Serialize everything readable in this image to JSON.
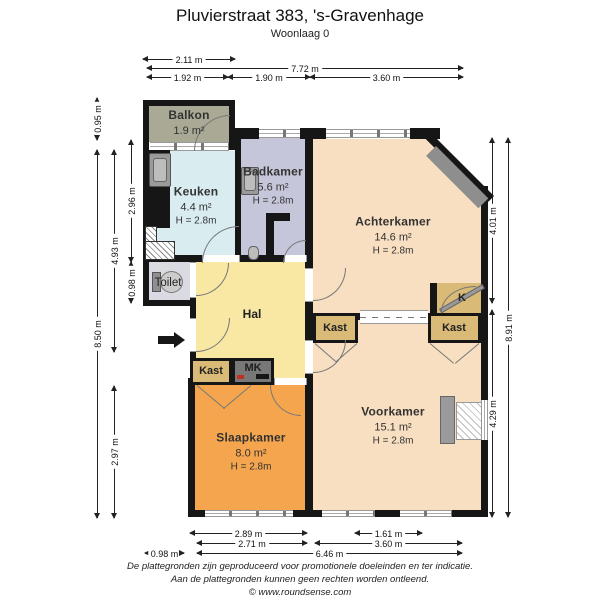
{
  "page": {
    "title": "Pluvierstraat 383, 's-Gravenhage",
    "subtitle": "Woonlaag 0"
  },
  "rooms": {
    "balkon": {
      "name": "Balkon",
      "area": "1.9 m²"
    },
    "keuken": {
      "name": "Keuken",
      "area": "4.4 m²",
      "height": "H = 2.8m"
    },
    "badkamer": {
      "name": "Badkamer",
      "area": "5.6 m²",
      "height": "H = 2.8m"
    },
    "achterkamer": {
      "name": "Achterkamer",
      "area": "14.6 m²",
      "height": "H = 2.8m"
    },
    "voorkamer": {
      "name": "Voorkamer",
      "area": "15.1 m²",
      "height": "H = 2.8m"
    },
    "slaapkamer": {
      "name": "Slaapkamer",
      "area": "8.0 m²",
      "height": "H = 2.8m"
    },
    "toilet": {
      "name": "Toilet"
    },
    "hal": {
      "name": "Hal"
    },
    "kast_hal": {
      "name": "Kast"
    },
    "kast_achter": {
      "name": "Kast"
    },
    "kast_voor": {
      "name": "Kast"
    },
    "mk": {
      "name": "MK"
    },
    "k": {
      "name": "K"
    }
  },
  "dimensions": {
    "top": [
      {
        "label": "2.11 m"
      },
      {
        "label": "7.72 m"
      },
      {
        "label": "1.92 m"
      },
      {
        "label": "1.90 m"
      },
      {
        "label": "3.60 m"
      }
    ],
    "left": [
      {
        "label": "0.95 m"
      },
      {
        "label": "8.50 m"
      },
      {
        "label": "4.93 m"
      },
      {
        "label": "2.97 m"
      },
      {
        "label": "2.96 m"
      },
      {
        "label": "0.98 m"
      }
    ],
    "right": [
      {
        "label": "4.01 m"
      },
      {
        "label": "4.29 m"
      },
      {
        "label": "8.91 m"
      }
    ],
    "bottom": [
      {
        "label": "2.89 m"
      },
      {
        "label": "1.61 m"
      },
      {
        "label": "2.71 m"
      },
      {
        "label": "3.60 m"
      },
      {
        "label": "0.98 m"
      },
      {
        "label": "6.46 m"
      }
    ]
  },
  "footer": {
    "line1": "De plattegronden zijn geproduceerd voor promotionele doeleinden en ter indicatie.",
    "line2": "Aan de plattegronden kunnen geen rechten worden ontleend.",
    "line3": "© www.roundsense.com"
  },
  "colors": {
    "wall": "#161616",
    "balkon": "#a9a995",
    "keuken": "#d9edf0",
    "badkamer": "#c6c6da",
    "kamers": "#f8dfc2",
    "hal": "#f8e8a3",
    "slaapkamer": "#f4a54e",
    "toilet": "#dadae3",
    "kast": "#d9ba77",
    "meterkast": "#787878"
  }
}
